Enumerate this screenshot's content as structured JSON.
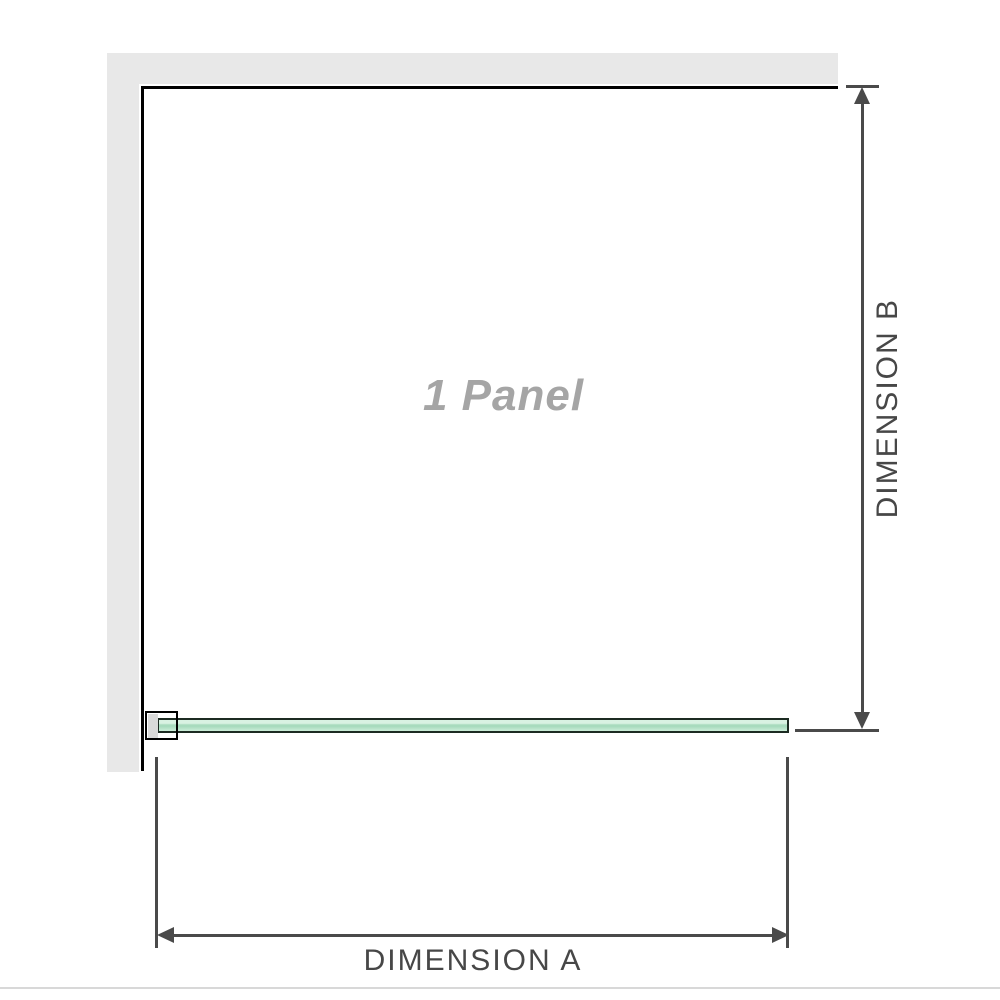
{
  "diagram": {
    "panel_label": "1 Panel",
    "dimension_a": {
      "label": "DIMENSION A",
      "orientation": "horizontal"
    },
    "dimension_b": {
      "label": "DIMENSION B",
      "orientation": "vertical"
    }
  },
  "colors": {
    "wall": "#e8e8e8",
    "outline": "#000000",
    "dim": "#4a4a4a",
    "dim-text": "#474747",
    "glass-border": "#1c2b22",
    "glass-top": "#d9f2e2",
    "glass-mid": "#a8dbbd",
    "glass-bottom": "#cdeeda",
    "panel-text": "#a5a5a5",
    "bracket-fill": "#d9d9d9",
    "divider": "#d8d8d8"
  }
}
